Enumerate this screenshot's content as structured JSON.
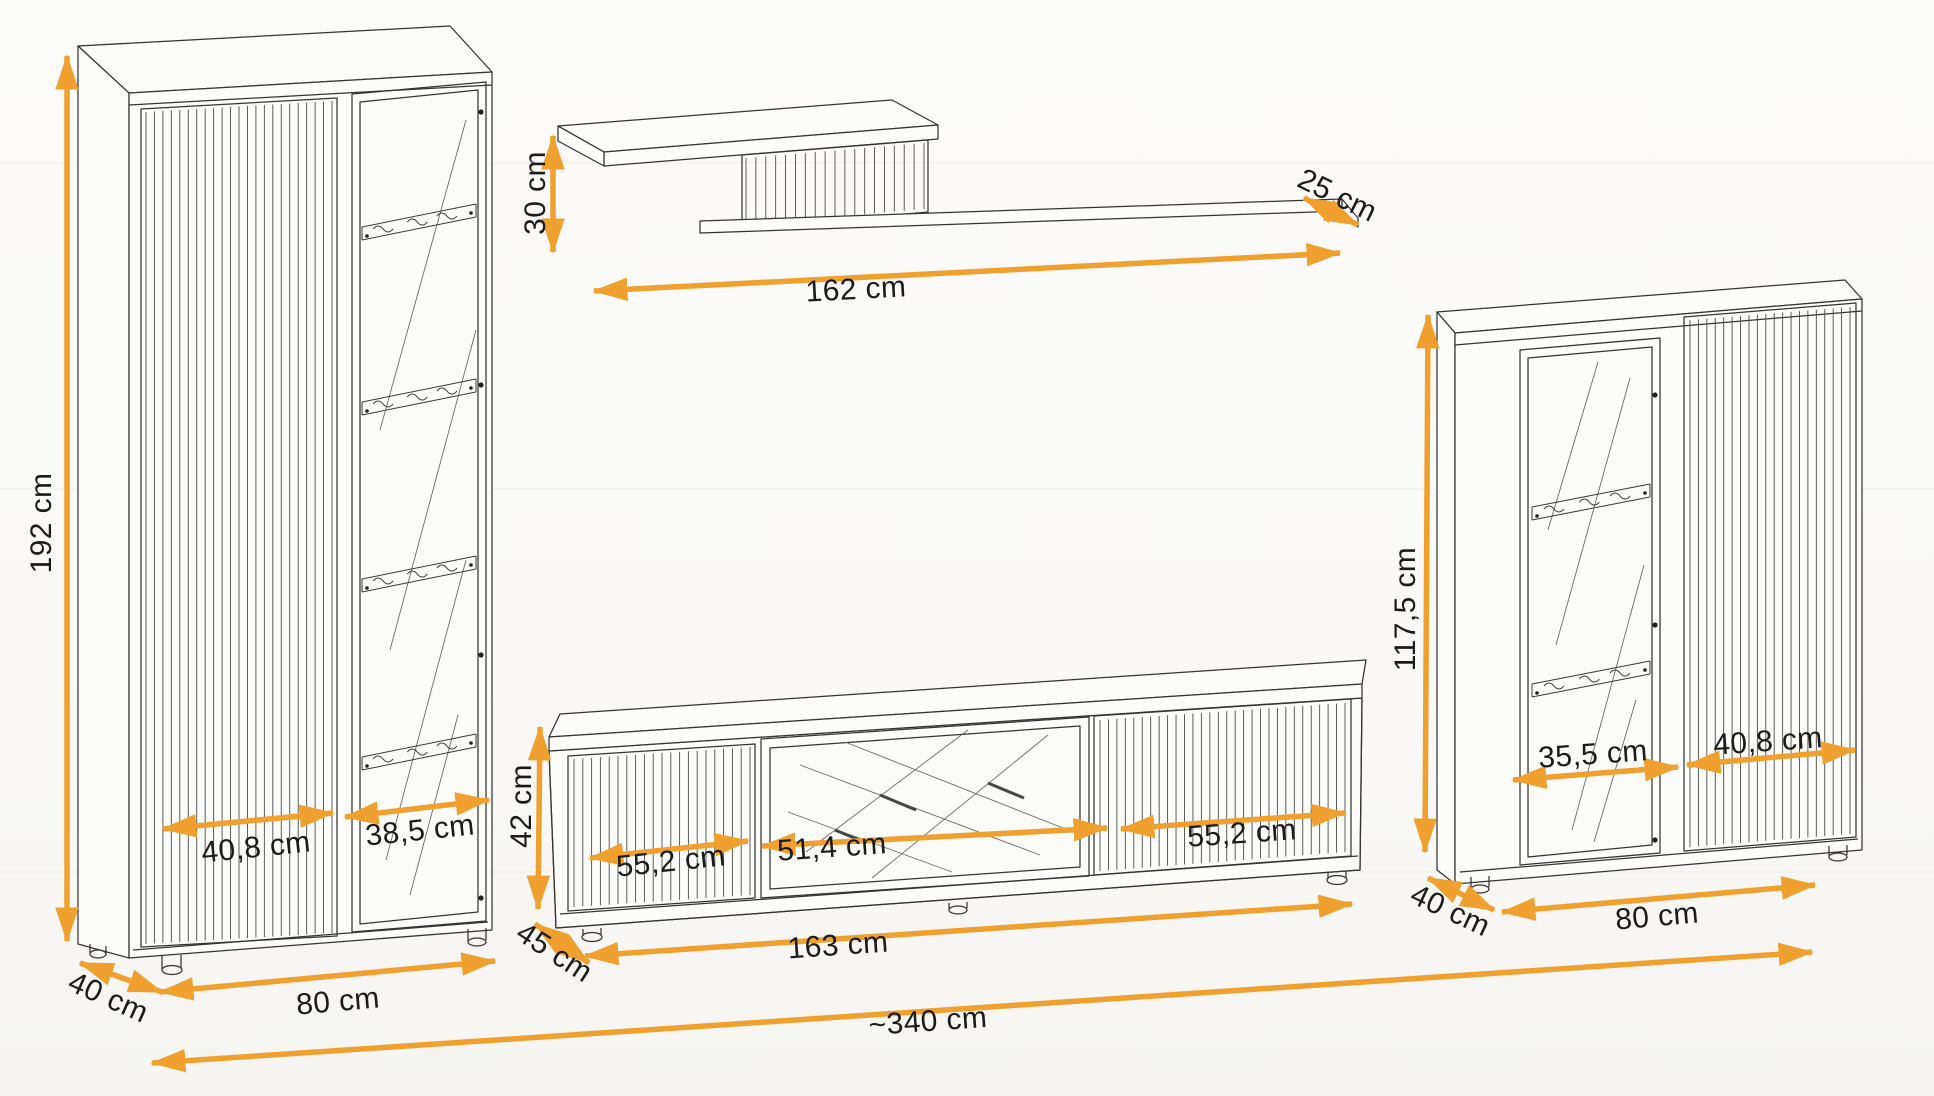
{
  "colors": {
    "arrow": "#F0A02F",
    "line": "#343434",
    "background": "#FAFAF8",
    "text": "#1B1B1B"
  },
  "tall_cabinet": {
    "height": "192 cm",
    "left_door_width": "40,8 cm",
    "right_door_width": "38,5 cm",
    "depth": "40 cm",
    "width": "80 cm"
  },
  "wall_shelf": {
    "height": "30 cm",
    "width": "162 cm",
    "depth": "25 cm"
  },
  "tv_stand": {
    "height": "42 cm",
    "left_door_width": "55,2 cm",
    "center_section_width": "51,4 cm",
    "right_door_width": "55,2 cm",
    "depth": "45 cm",
    "width": "163 cm"
  },
  "display_cabinet": {
    "height": "117,5 cm",
    "glass_door_width": "35,5 cm",
    "fluted_door_width": "40,8 cm",
    "depth": "40 cm",
    "width": "80 cm"
  },
  "total": {
    "width": "~340 cm"
  }
}
